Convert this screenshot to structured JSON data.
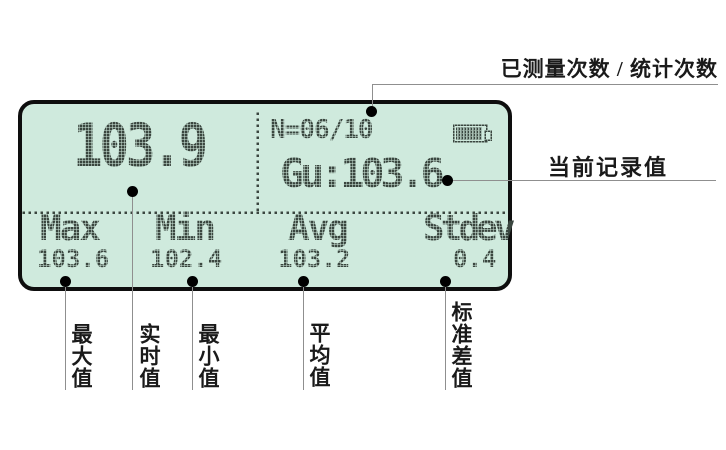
{
  "device": {
    "lcd": {
      "main_reading": "103.9",
      "count_line": "N=06/10",
      "record_line": "Gu:103.6",
      "battery_icon": "battery-icon",
      "stats": [
        {
          "label": "Max",
          "value": "103.6"
        },
        {
          "label": "Min",
          "value": "102.4"
        },
        {
          "label": "Avg",
          "value": "103.2"
        },
        {
          "label": "Stdev",
          "value": "0.4"
        }
      ]
    }
  },
  "annotations": {
    "measure_count": "已测量次数 / 统计次数",
    "current_record": "当前记录值",
    "max_value": "最大值",
    "realtime_value": "实时值",
    "min_value": "最小值",
    "avg_value": "平均值",
    "stdev_value": "标准差值"
  },
  "colors": {
    "lcd_bg": "#cfeadd",
    "lcd_text": "#3a463f",
    "bezel": "#0e0e0e",
    "line": "#8f8f8f",
    "label": "#1a1a1a",
    "page_bg": "#ffffff"
  }
}
